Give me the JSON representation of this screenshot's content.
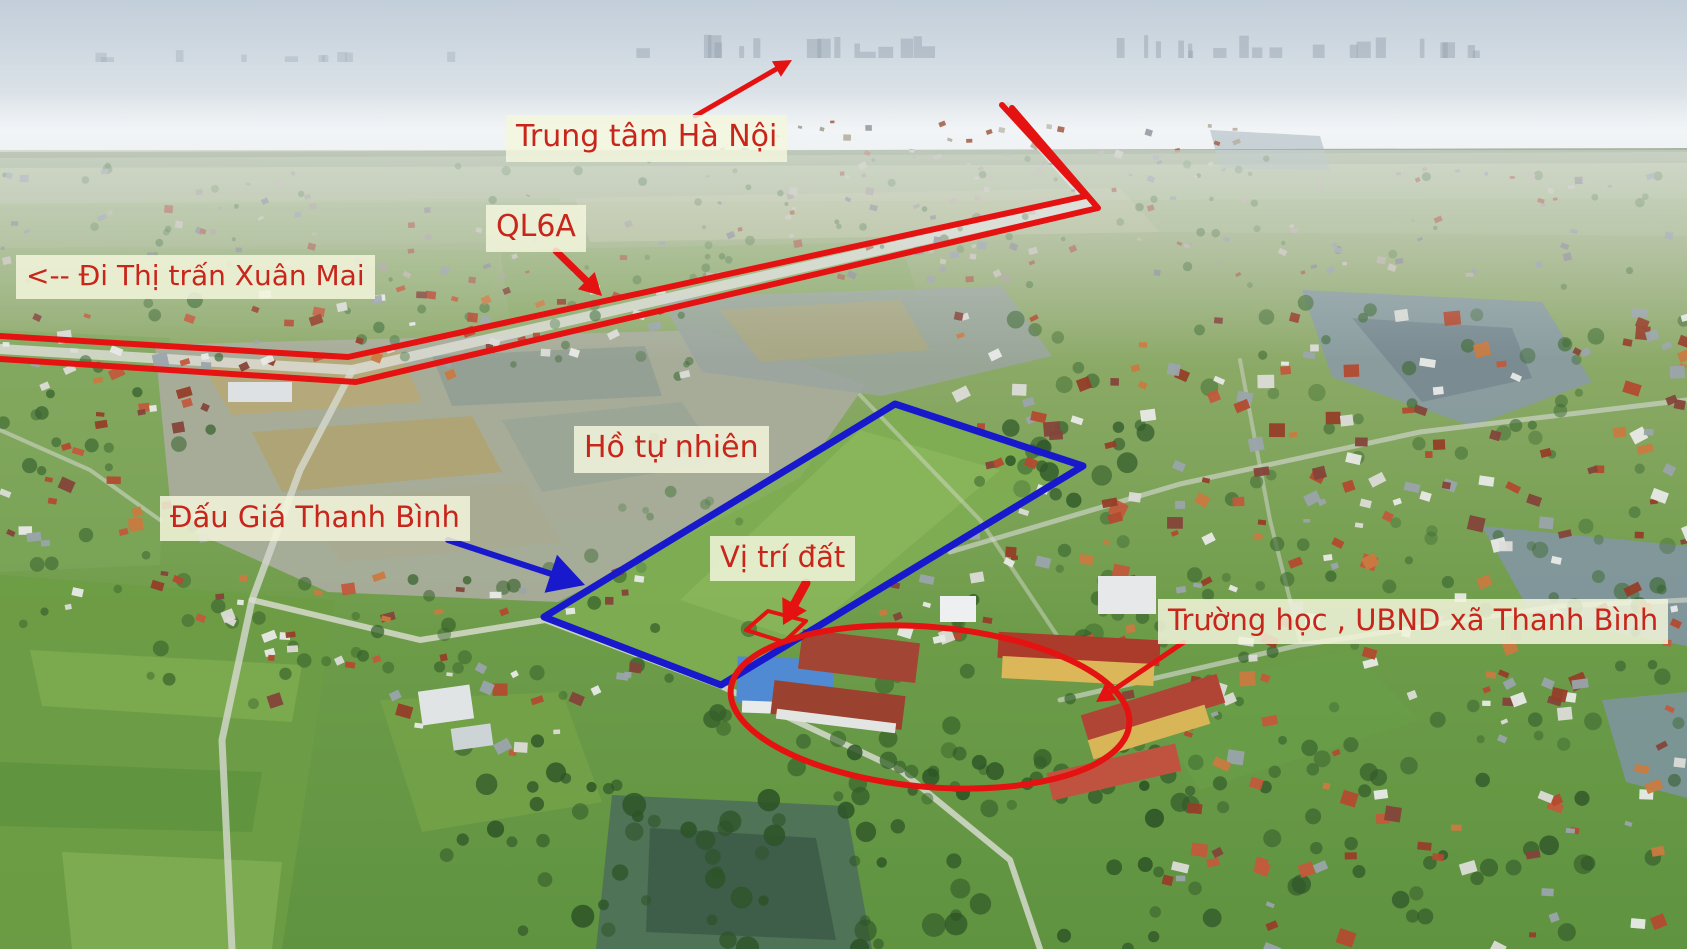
{
  "labels": {
    "hanoi": "Trung tâm Hà Nội",
    "ql6a": "QL6A",
    "xuan_mai": "<-- Đi Thị trấn Xuân Mai",
    "lake": "Hồ tự nhiên",
    "auction": "Đấu Giá Thanh Bình",
    "plot": "Vị trí đất",
    "school": "Trường học , UBND xã Thanh Bình"
  },
  "colors": {
    "annotation_red": "#e51212",
    "annotation_blue": "#1818cc",
    "label_text": "#c8251b",
    "label_background": "#f3f6dc"
  },
  "annotations": {
    "road_ql6a": {
      "name": "ql6a-highway-line",
      "upper": [
        [
          0,
          336
        ],
        [
          348,
          357
        ],
        [
          1086,
          196
        ],
        [
          1002,
          105
        ]
      ],
      "lower": [
        [
          0,
          359
        ],
        [
          356,
          382
        ],
        [
          1098,
          208
        ],
        [
          1012,
          108
        ]
      ],
      "width": 6
    },
    "auction_polygon": {
      "name": "auction-land-boundary",
      "points": [
        [
          895,
          404
        ],
        [
          1083,
          466
        ],
        [
          721,
          685
        ],
        [
          544,
          617
        ]
      ],
      "width": 7
    },
    "school_ellipse": {
      "name": "school-ubnd-ellipse",
      "cx": 930,
      "cy": 707,
      "rx": 200,
      "ry": 80,
      "rotate": 5,
      "width": 6
    },
    "plot_marker": {
      "name": "plot-location-marker",
      "points": [
        [
          746,
          630
        ],
        [
          768,
          611
        ],
        [
          806,
          621
        ],
        [
          784,
          642
        ]
      ],
      "width": 4
    },
    "arrows": [
      {
        "name": "hanoi-direction-arrow",
        "color": "red",
        "from": [
          695,
          116
        ],
        "to": [
          792,
          60
        ],
        "width": 5,
        "head_len": 18,
        "head_w": 9
      },
      {
        "name": "ql6a-pointer-arrow",
        "color": "red",
        "from": [
          556,
          251
        ],
        "to": [
          602,
          296
        ],
        "width": 7,
        "head_len": 22,
        "head_w": 12
      },
      {
        "name": "auction-pointer-arrow",
        "color": "blue",
        "from": [
          448,
          540
        ],
        "to": [
          585,
          585
        ],
        "width": 6,
        "head_len": 36,
        "head_w": 20
      },
      {
        "name": "plot-pointer-arrow",
        "color": "red",
        "from": [
          806,
          583
        ],
        "to": [
          783,
          625
        ],
        "width": 9,
        "head_len": 24,
        "head_w": 14
      },
      {
        "name": "school-pointer-arrow",
        "color": "red",
        "from": [
          1184,
          642
        ],
        "to": [
          1096,
          702
        ],
        "width": 5,
        "head_len": 18,
        "head_w": 10
      }
    ]
  }
}
